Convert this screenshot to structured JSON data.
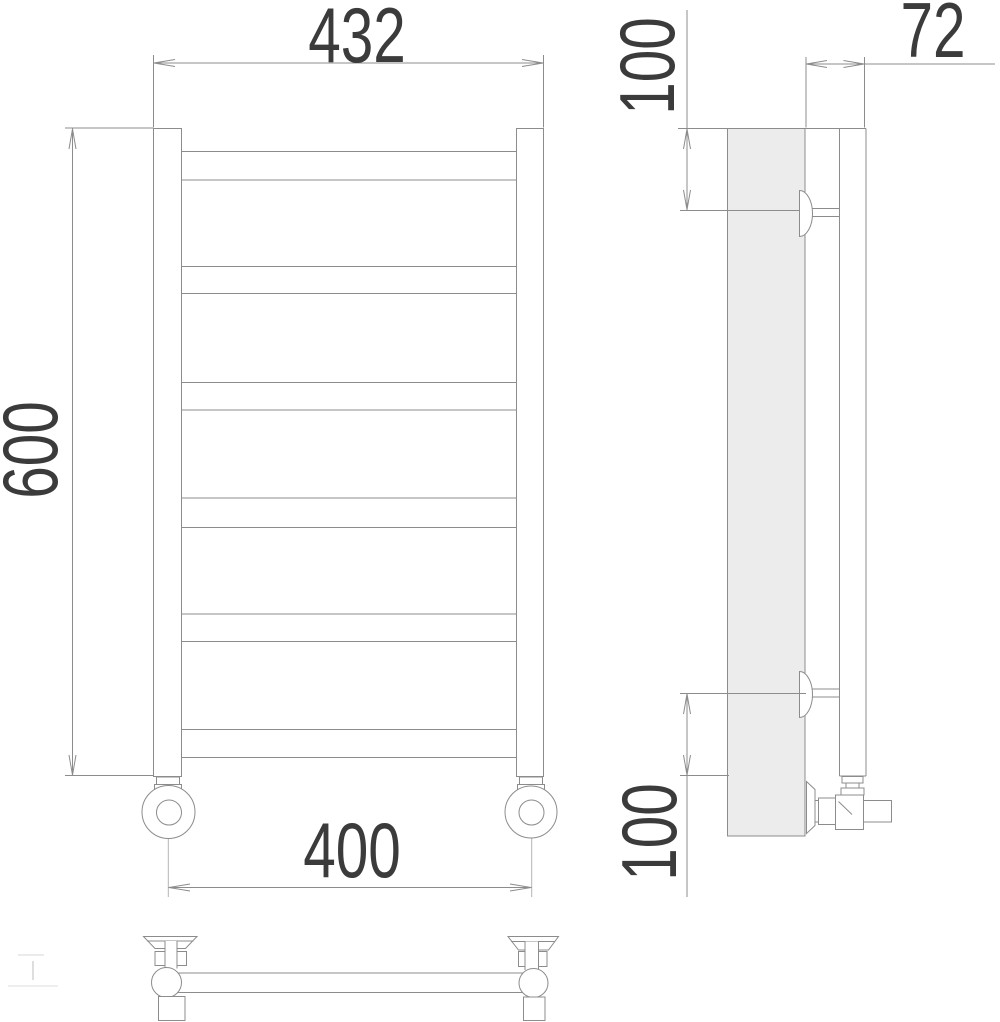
{
  "dimensions": {
    "front": {
      "overall_width": "432",
      "overall_height": "600",
      "valve_spacing": "400"
    },
    "side": {
      "depth": "72",
      "top_bracket_offset": "100",
      "bottom_bracket_offset": "100"
    }
  },
  "colors": {
    "line": "#8c8c8c",
    "line_light": "#b4b4b4",
    "dim_text": "#3b3b3b",
    "wall_fill": "#ececec",
    "background": "#ffffff"
  }
}
